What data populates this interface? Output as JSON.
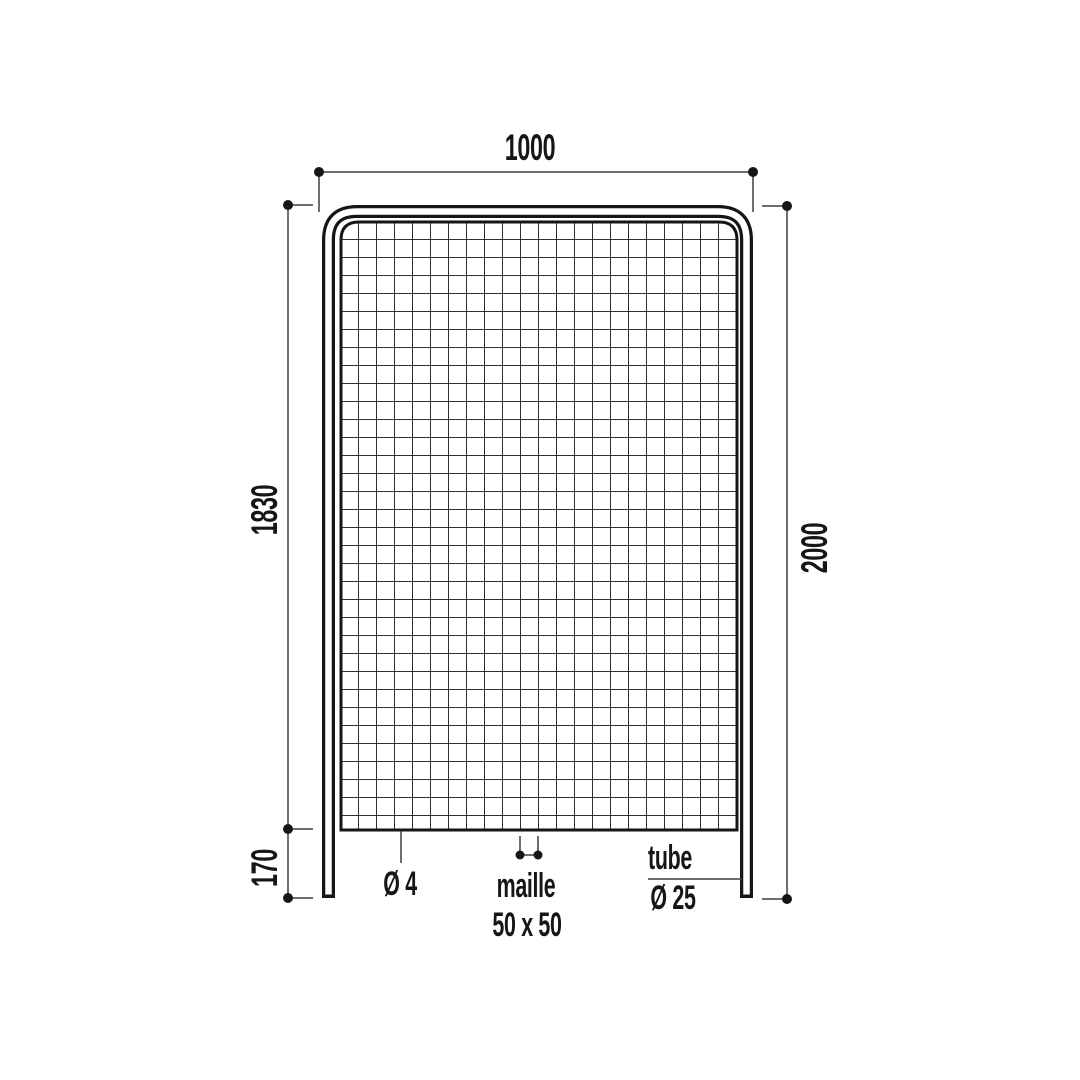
{
  "page": {
    "background": "#ffffff"
  },
  "drawing": {
    "colors": {
      "structure_line": "#161616",
      "dimension_line": "#3f3f3f",
      "text": "#161616",
      "background": "#ffffff"
    },
    "dimensions": {
      "top_width": "1000",
      "mesh_height": "1830",
      "total_height": "2000",
      "leg_height": "170"
    },
    "annotations": {
      "wire_diameter": "Ø 4",
      "mesh_word": "maille",
      "mesh_size": "50 x 50",
      "tube_word": "tube",
      "tube_diameter": "Ø 25"
    }
  }
}
